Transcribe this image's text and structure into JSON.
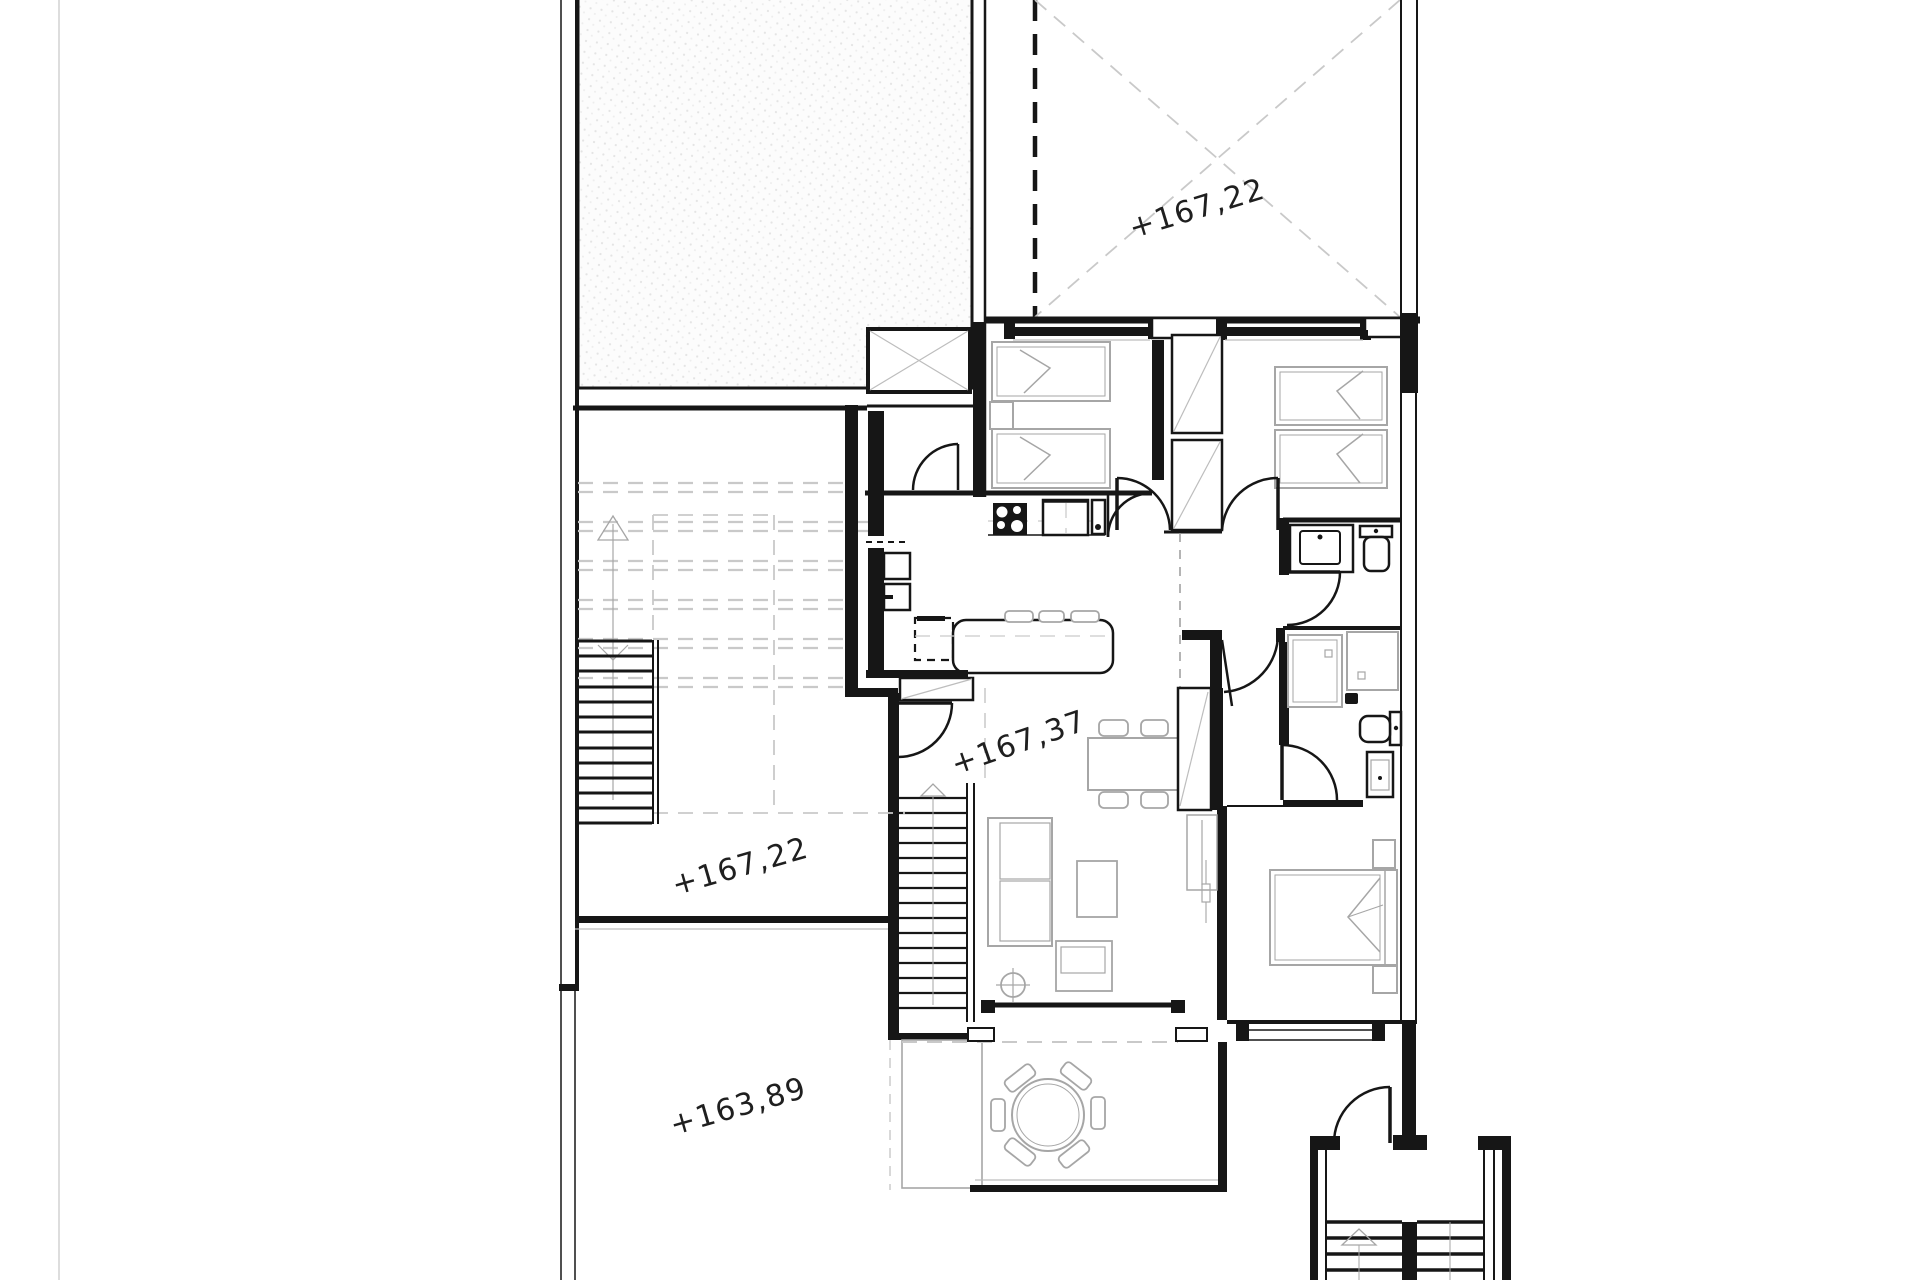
{
  "plan": {
    "type": "architectural-floor-plan",
    "elevation_labels": [
      {
        "id": "roof-terrace",
        "value": "+167,22"
      },
      {
        "id": "living-level",
        "value": "+167,37"
      },
      {
        "id": "upper-terrace",
        "value": "+167,22"
      },
      {
        "id": "lower-terrace",
        "value": "+163,89"
      }
    ],
    "colors": {
      "walls": "#161616",
      "furniture": "#a6a6a6",
      "guides": "#c9c9c9",
      "hatch_dot": "#e4e4e4",
      "paper": "#ffffff"
    }
  }
}
